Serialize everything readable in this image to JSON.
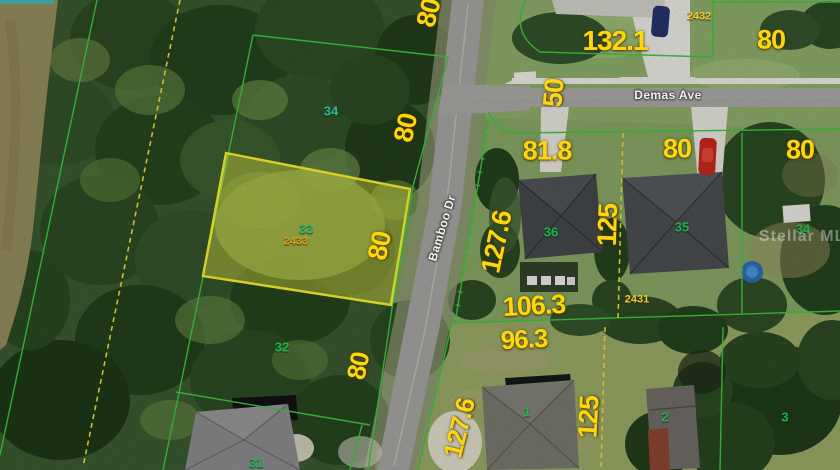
{
  "map": {
    "type": "aerial-parcel-map",
    "streets": {
      "demas": "Demas Ave",
      "bamboo": "Bamboo Dr"
    },
    "watermark": "Stellar MLS",
    "highlight": {
      "lot": "33",
      "parcel_id": "2433"
    },
    "dimensions": [
      {
        "id": "dim-80-nw",
        "text": "80"
      },
      {
        "id": "dim-132-1",
        "text": "132.1"
      },
      {
        "id": "dim-80-ne",
        "text": "80"
      },
      {
        "id": "dim-50",
        "text": "50"
      },
      {
        "id": "dim-80-lot34w",
        "text": "80"
      },
      {
        "id": "dim-81-8",
        "text": "81.8"
      },
      {
        "id": "dim-80-lot35",
        "text": "80"
      },
      {
        "id": "dim-80-lot34e",
        "text": "80"
      },
      {
        "id": "dim-127-6-n",
        "text": "127.6"
      },
      {
        "id": "dim-125-n",
        "text": "125"
      },
      {
        "id": "dim-80-lot33",
        "text": "80"
      },
      {
        "id": "dim-106-3",
        "text": "106.3"
      },
      {
        "id": "dim-96-3",
        "text": "96.3"
      },
      {
        "id": "dim-127-6-s",
        "text": "127.6"
      },
      {
        "id": "dim-125-s",
        "text": "125"
      },
      {
        "id": "dim-80-lot32",
        "text": "80"
      }
    ],
    "lot_numbers": [
      {
        "id": "lot-34-west",
        "text": "34"
      },
      {
        "id": "lot-33",
        "text": "33"
      },
      {
        "id": "lot-32",
        "text": "32"
      },
      {
        "id": "lot-31",
        "text": "31"
      },
      {
        "id": "lot-36",
        "text": "36"
      },
      {
        "id": "lot-35",
        "text": "35"
      },
      {
        "id": "lot-34-east",
        "text": "34"
      },
      {
        "id": "lot-1",
        "text": "1"
      },
      {
        "id": "lot-2",
        "text": "2"
      },
      {
        "id": "lot-3",
        "text": "3"
      }
    ],
    "parcel_ids": [
      {
        "id": "parcel-2432",
        "text": "2432"
      },
      {
        "id": "parcel-2433",
        "text": "2433"
      },
      {
        "id": "parcel-2431",
        "text": "2431"
      }
    ],
    "colors": {
      "dimension_yellow": "#ffd60a",
      "lot_number_green": "#22b14c",
      "lot_number_teal": "#35b39b",
      "parcel_id_gold": "#d8a018",
      "boundary_green": "#3ec43e",
      "dashed_boundary_yellow": "#e8d832",
      "highlight_fill": "rgba(238,238,70,0.42)",
      "highlight_stroke": "#f4ee2c",
      "road_gray": "#a2a2a0",
      "concrete_white": "#e7e7e1"
    }
  }
}
